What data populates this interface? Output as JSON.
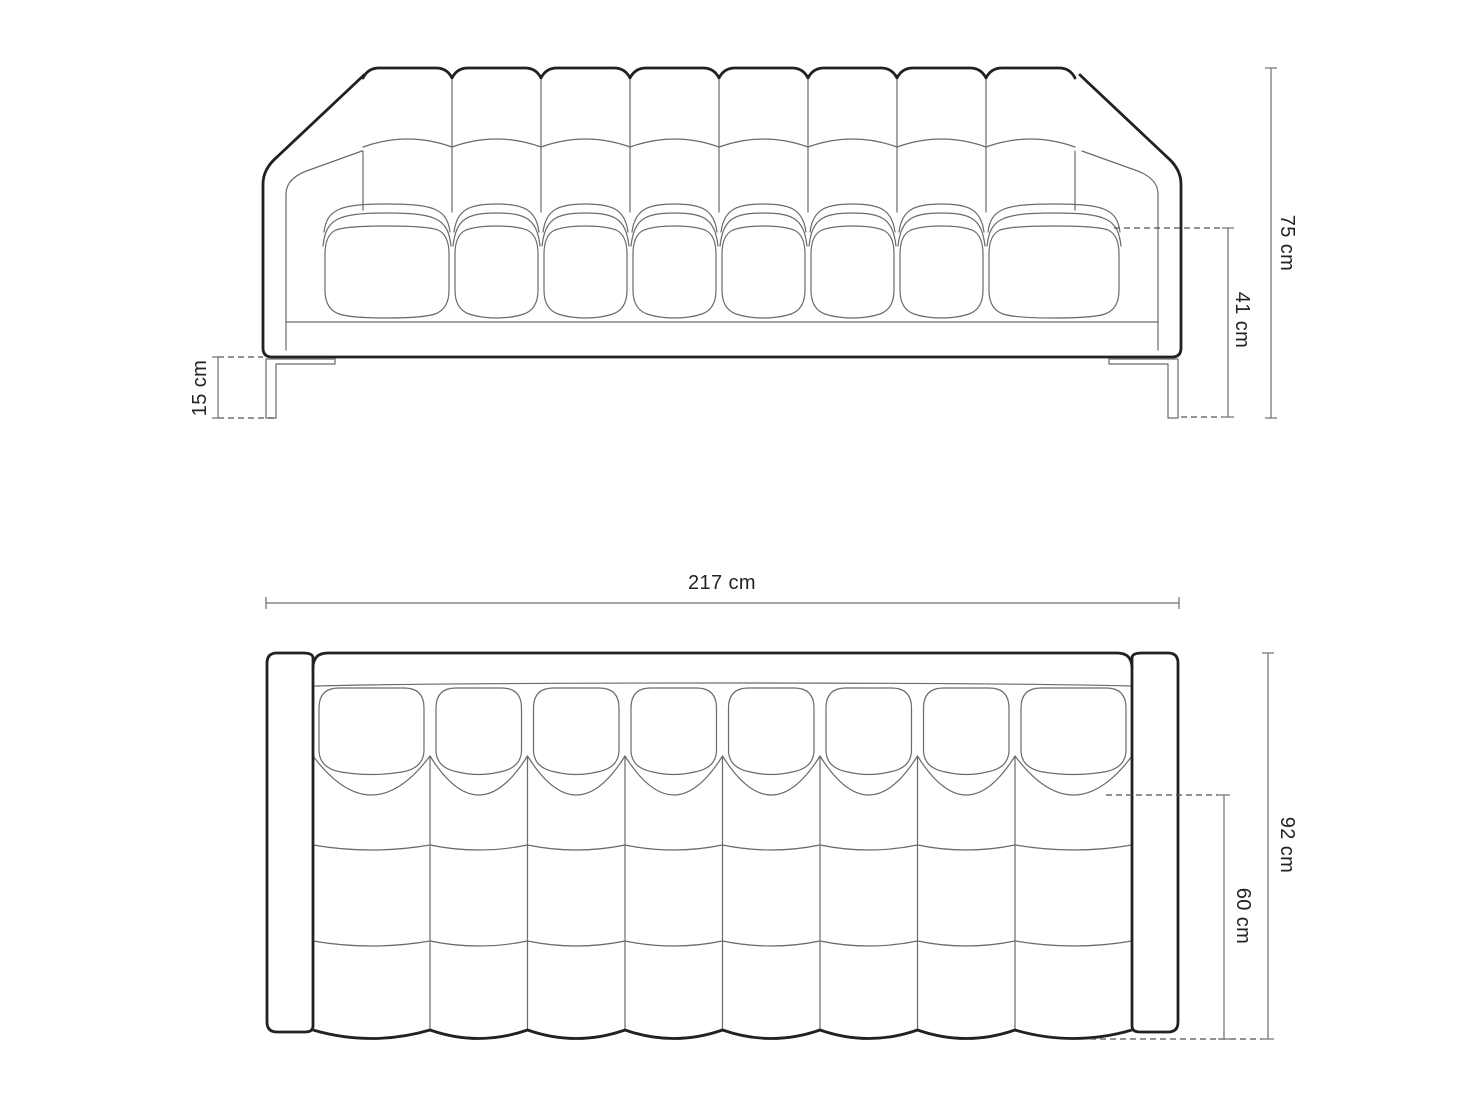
{
  "diagram": {
    "title": "sofa-dimension-drawing",
    "background": "#ffffff",
    "colors": {
      "outline": "#212121",
      "detail": "#6a6a6a",
      "dimension": "#6f6f6f",
      "dash": "#555555",
      "text": "#232323"
    },
    "front_view": {
      "sections": 8,
      "seat_cushions": 8,
      "dimensions": {
        "overall_height": "75 cm",
        "seat_height": "41 cm",
        "leg_height": "15 cm"
      }
    },
    "top_view": {
      "sections": 8,
      "back_cushions": 8,
      "dimensions": {
        "overall_width": "217 cm",
        "overall_depth": "92 cm",
        "seat_depth": "60 cm"
      }
    }
  }
}
